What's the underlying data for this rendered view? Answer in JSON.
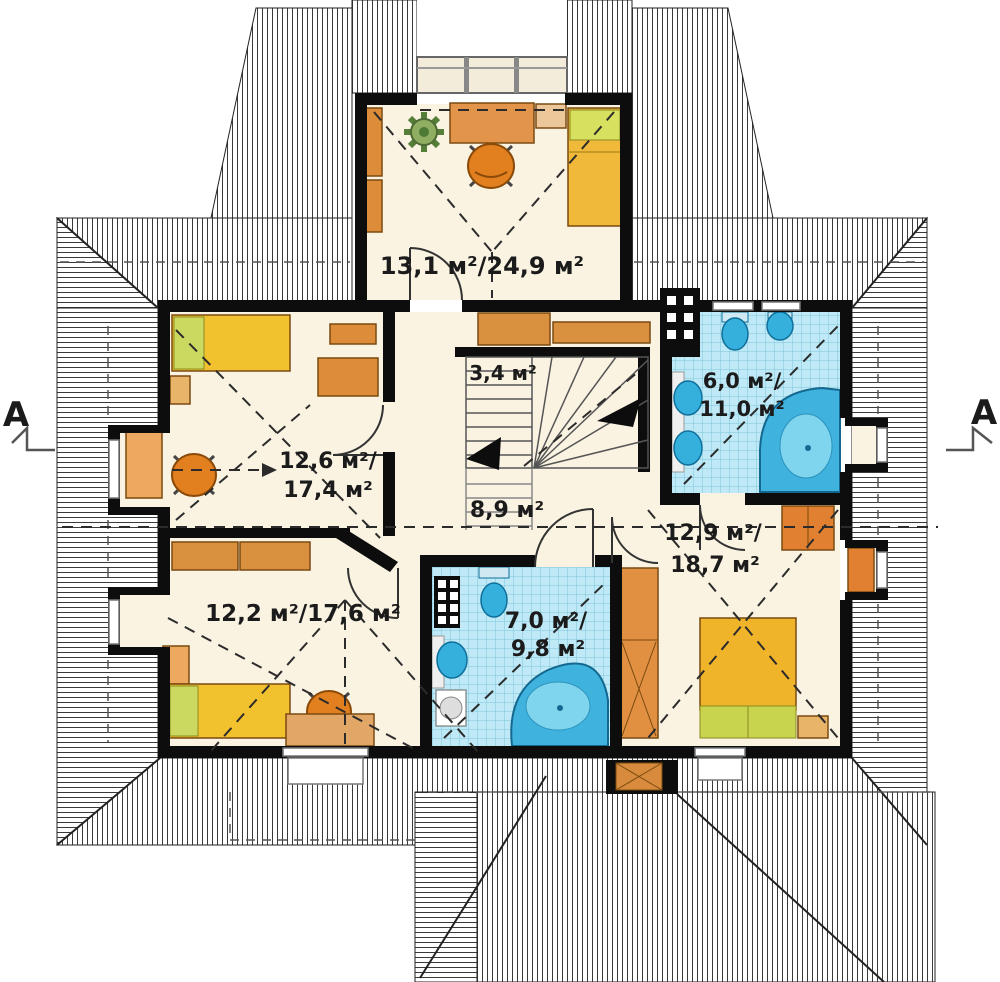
{
  "labels": {
    "room_top": "13,1 м²/24,9 м²",
    "stairs": "3,4 м²",
    "bath_right_line1": "6,0 м²/",
    "bath_right_line2": "11,0 м²",
    "room_left_line1": "12,6 м²/",
    "room_left_line2": "17,4 м²",
    "hall": "8,9 м²",
    "room_right_line1": "12,9 м²/",
    "room_right_line2": "18,7 м²",
    "room_bottom_left": "12,2 м²/17,6 м²",
    "bath_bottom_line1": "7,0 м²/",
    "bath_bottom_line2": "9,8 м²"
  },
  "section_markers": {
    "left": "A",
    "right": "A"
  },
  "colors": {
    "wall": "#0d0d0d",
    "floor": "#faf3e2",
    "roof_hatch_line": "#3a3a3a",
    "tile_background": "#bfe9f6",
    "tile_line": "#7cc5da",
    "furniture_orange": "#dd8d3a",
    "bed_yellow": "#f2c22e",
    "pillow_green": "#ccd960",
    "fixture_blue": "#35b0dc"
  }
}
